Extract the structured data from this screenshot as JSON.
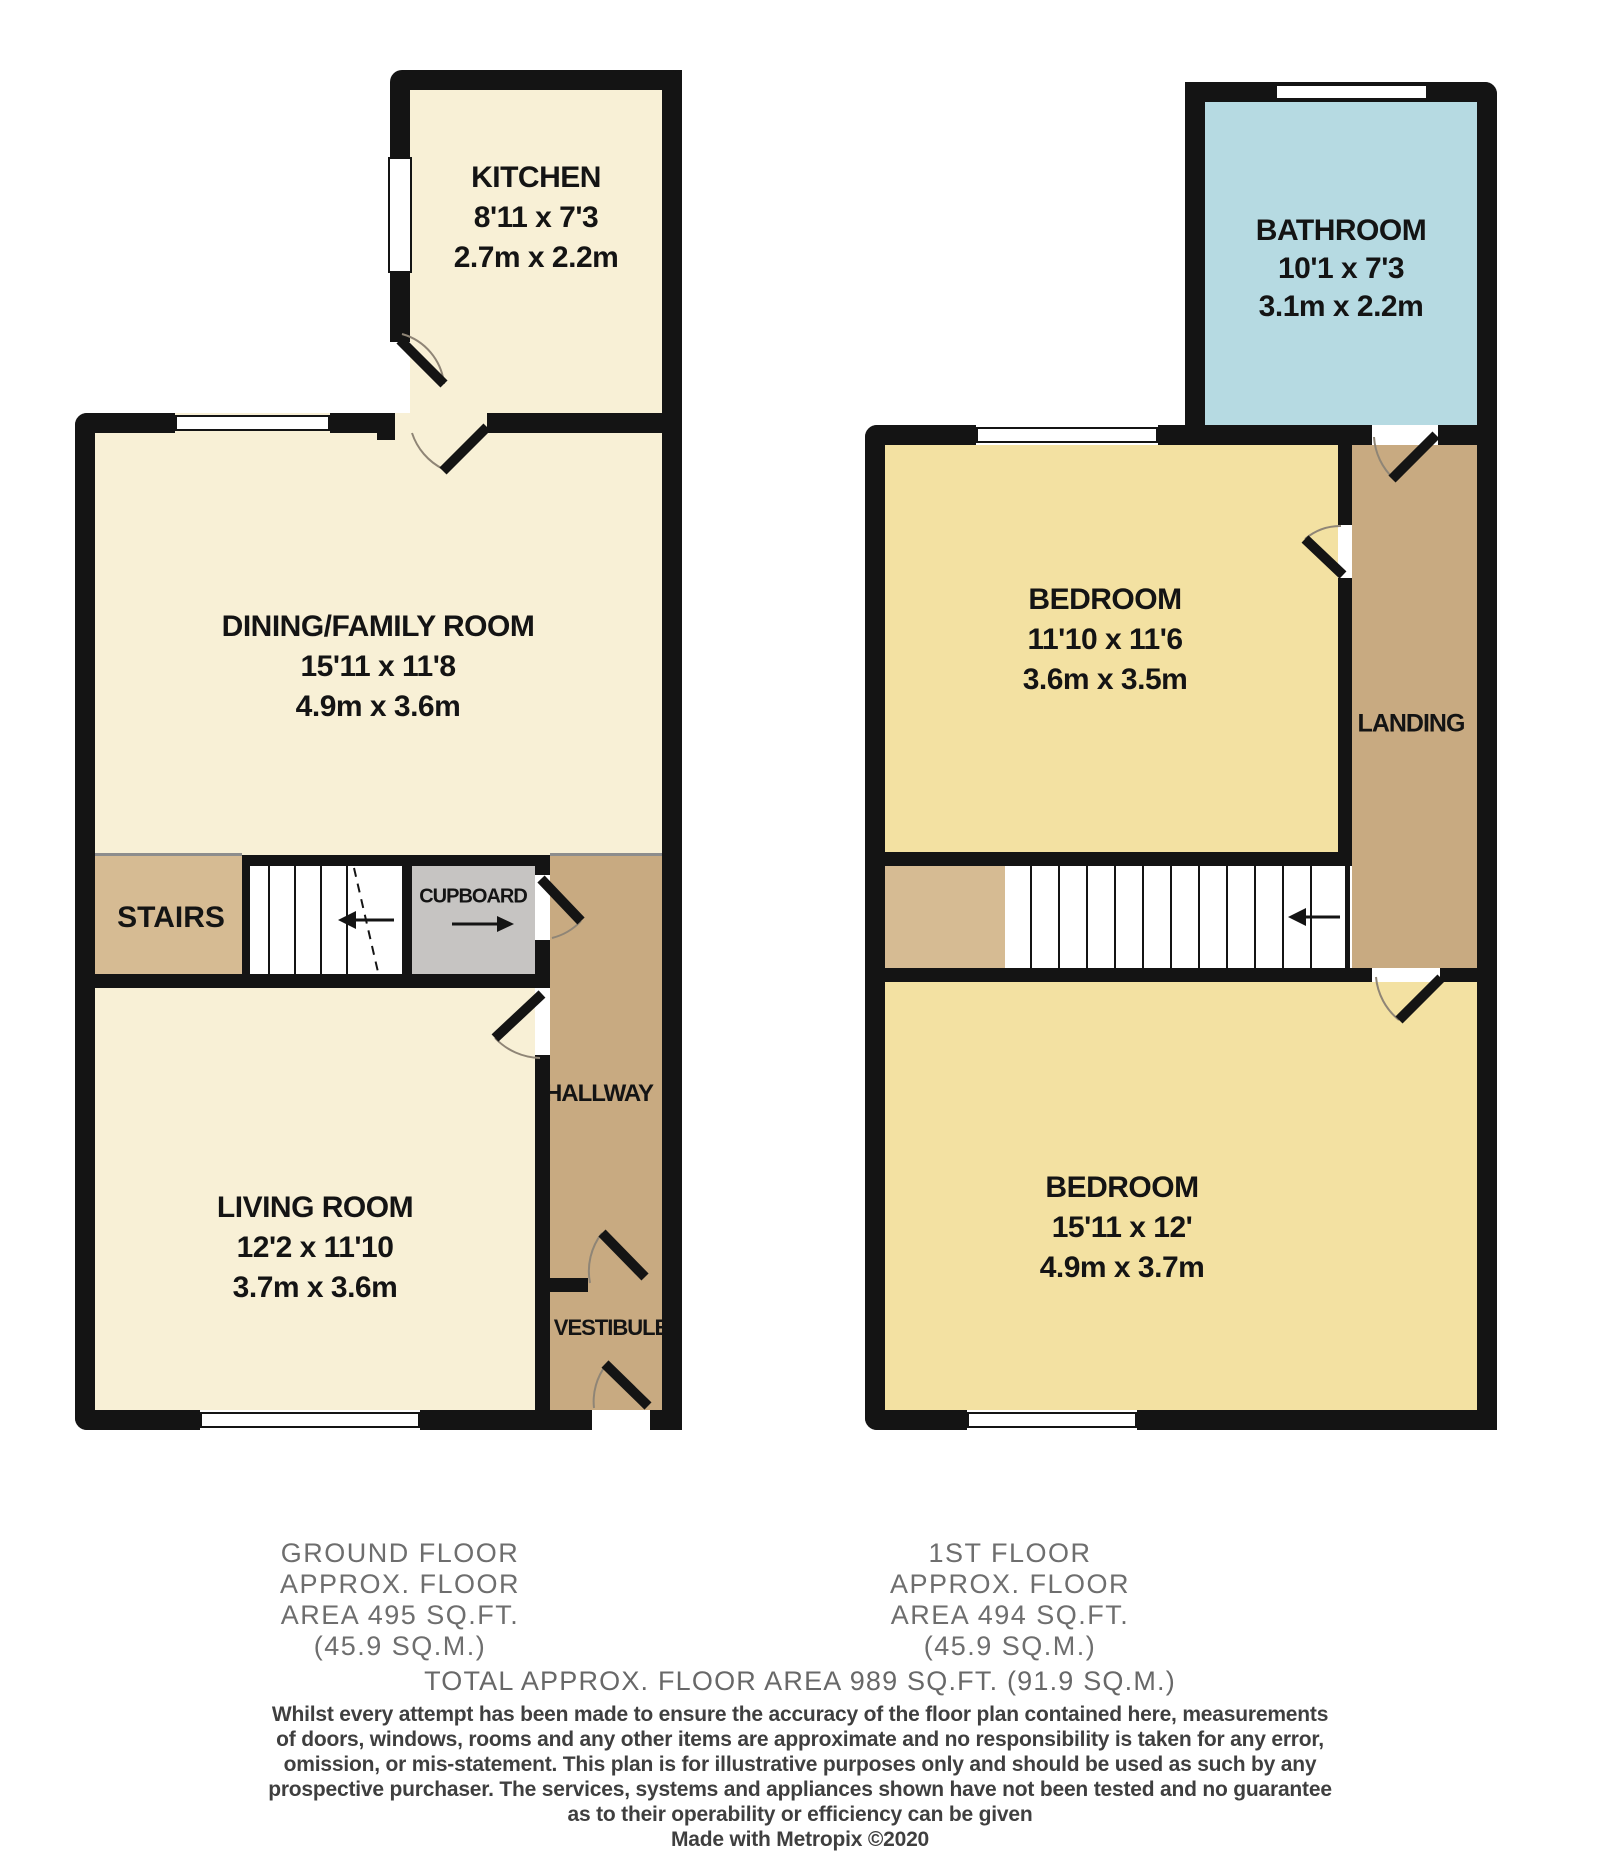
{
  "ground": {
    "kitchen": {
      "name": "KITCHEN",
      "size_imperial": "8'11 x 7'3",
      "size_metric": "2.7m x 2.2m"
    },
    "dining": {
      "name": "DINING/FAMILY ROOM",
      "size_imperial": "15'11 x 11'8",
      "size_metric": "4.9m x 3.6m"
    },
    "living": {
      "name": "LIVING ROOM",
      "size_imperial": "12'2 x 11'10",
      "size_metric": "3.7m x 3.6m"
    },
    "stairs_label": "STAIRS",
    "cupboard_label": "CUPBOARD",
    "hallway_label": "HALLWAY",
    "vestibule_label": "VESTIBULE",
    "footer": {
      "line1": "GROUND FLOOR",
      "line2": "APPROX. FLOOR",
      "line3": "AREA 495 SQ.FT.",
      "line4": "(45.9 SQ.M.)"
    }
  },
  "first": {
    "bathroom": {
      "name": "BATHROOM",
      "size_imperial": "10'1 x 7'3",
      "size_metric": "3.1m x 2.2m"
    },
    "bedroom1": {
      "name": "BEDROOM",
      "size_imperial": "11'10 x 11'6",
      "size_metric": "3.6m x 3.5m"
    },
    "bedroom2": {
      "name": "BEDROOM",
      "size_imperial": "15'11 x 12'",
      "size_metric": "4.9m x 3.7m"
    },
    "landing_label": "LANDING",
    "footer": {
      "line1": "1ST FLOOR",
      "line2": "APPROX. FLOOR",
      "line3": "AREA 494 SQ.FT.",
      "line4": "(45.9 SQ.M.)"
    }
  },
  "summary": {
    "total": "TOTAL APPROX. FLOOR AREA 989 SQ.FT. (91.9 SQ.M.)",
    "disclaimer1": "Whilst every attempt has been made to ensure the accuracy of the floor plan contained here, measurements",
    "disclaimer2": "of doors, windows, rooms and any other items are approximate and no responsibility is taken for any error,",
    "disclaimer3": "omission, or mis-statement. This plan is for illustrative purposes only and should be used as such by any",
    "disclaimer4": "prospective purchaser. The services, systems and appliances shown have not been tested and no guarantee",
    "disclaimer5": "as to their operability or efficiency can be given",
    "credit": "Made with Metropix ©2020"
  },
  "colors": {
    "wall": "#141414",
    "room_cream": "#f8f0d6",
    "room_yellow": "#f3e1a2",
    "room_blue": "#b6dae2",
    "stairs_tan_light": "#d6bb93",
    "circulation_tan": "#c8aa81",
    "cupboard_gray": "#c6c4c2",
    "window_white": "#ffffff",
    "footer_text": "#6e6e6e",
    "disclaimer_text": "#3f3f3f"
  }
}
